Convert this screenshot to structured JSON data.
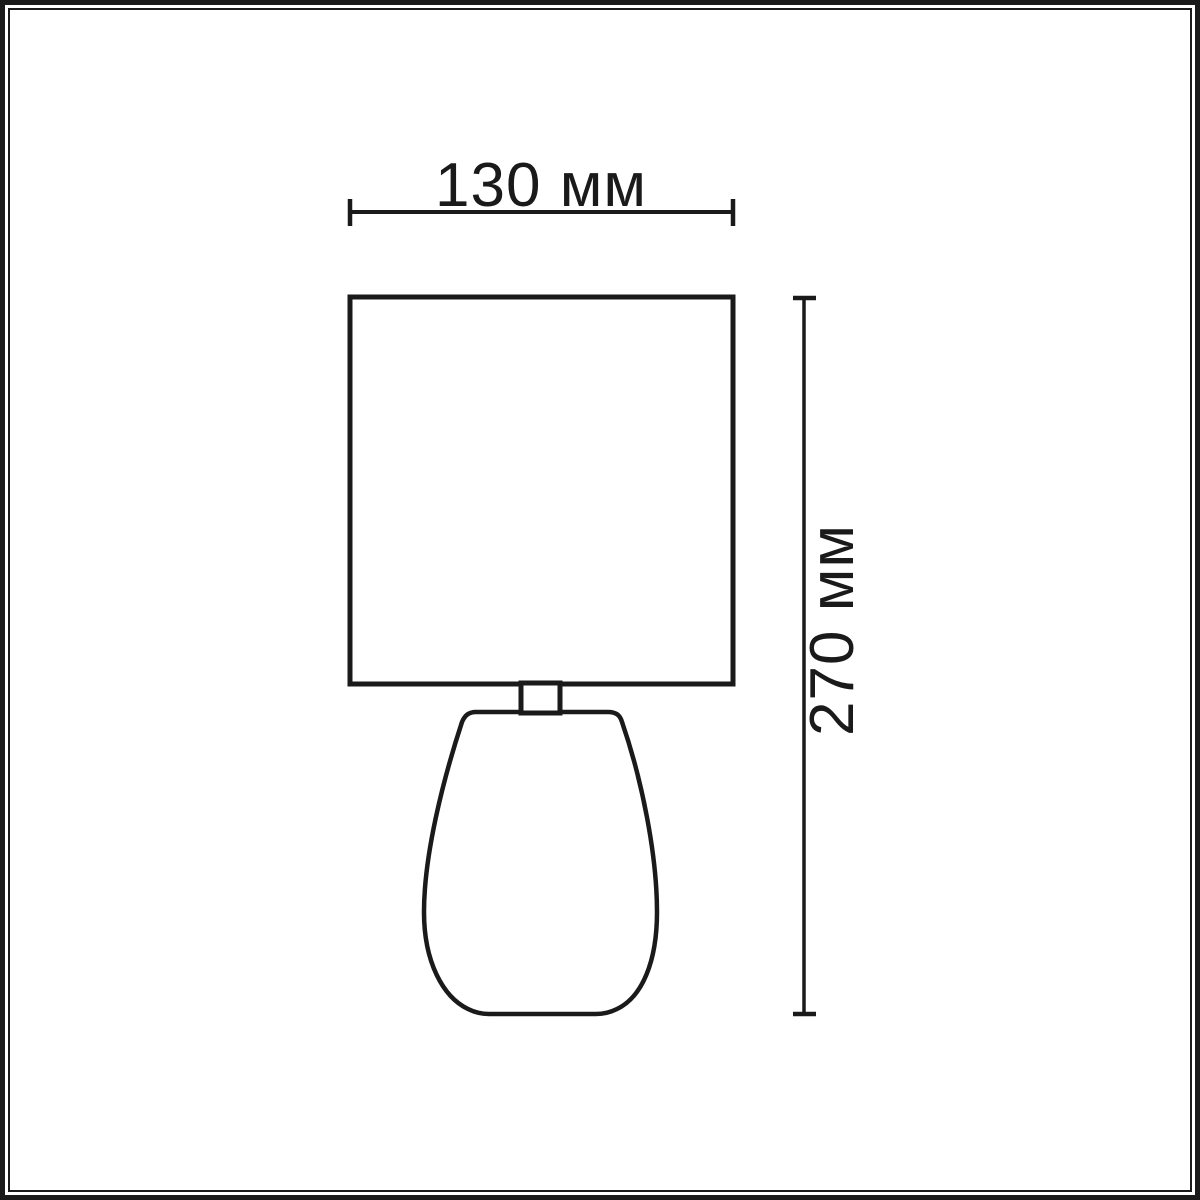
{
  "frame": {
    "border_color": "#1a1a1a",
    "background_color": "#ffffff"
  },
  "drawing": {
    "kind": "lamp-dimension-diagram",
    "stroke_color": "#1a1a1a",
    "width_dimension": {
      "label": "130 мм"
    },
    "height_dimension": {
      "label": "270 мм"
    }
  }
}
